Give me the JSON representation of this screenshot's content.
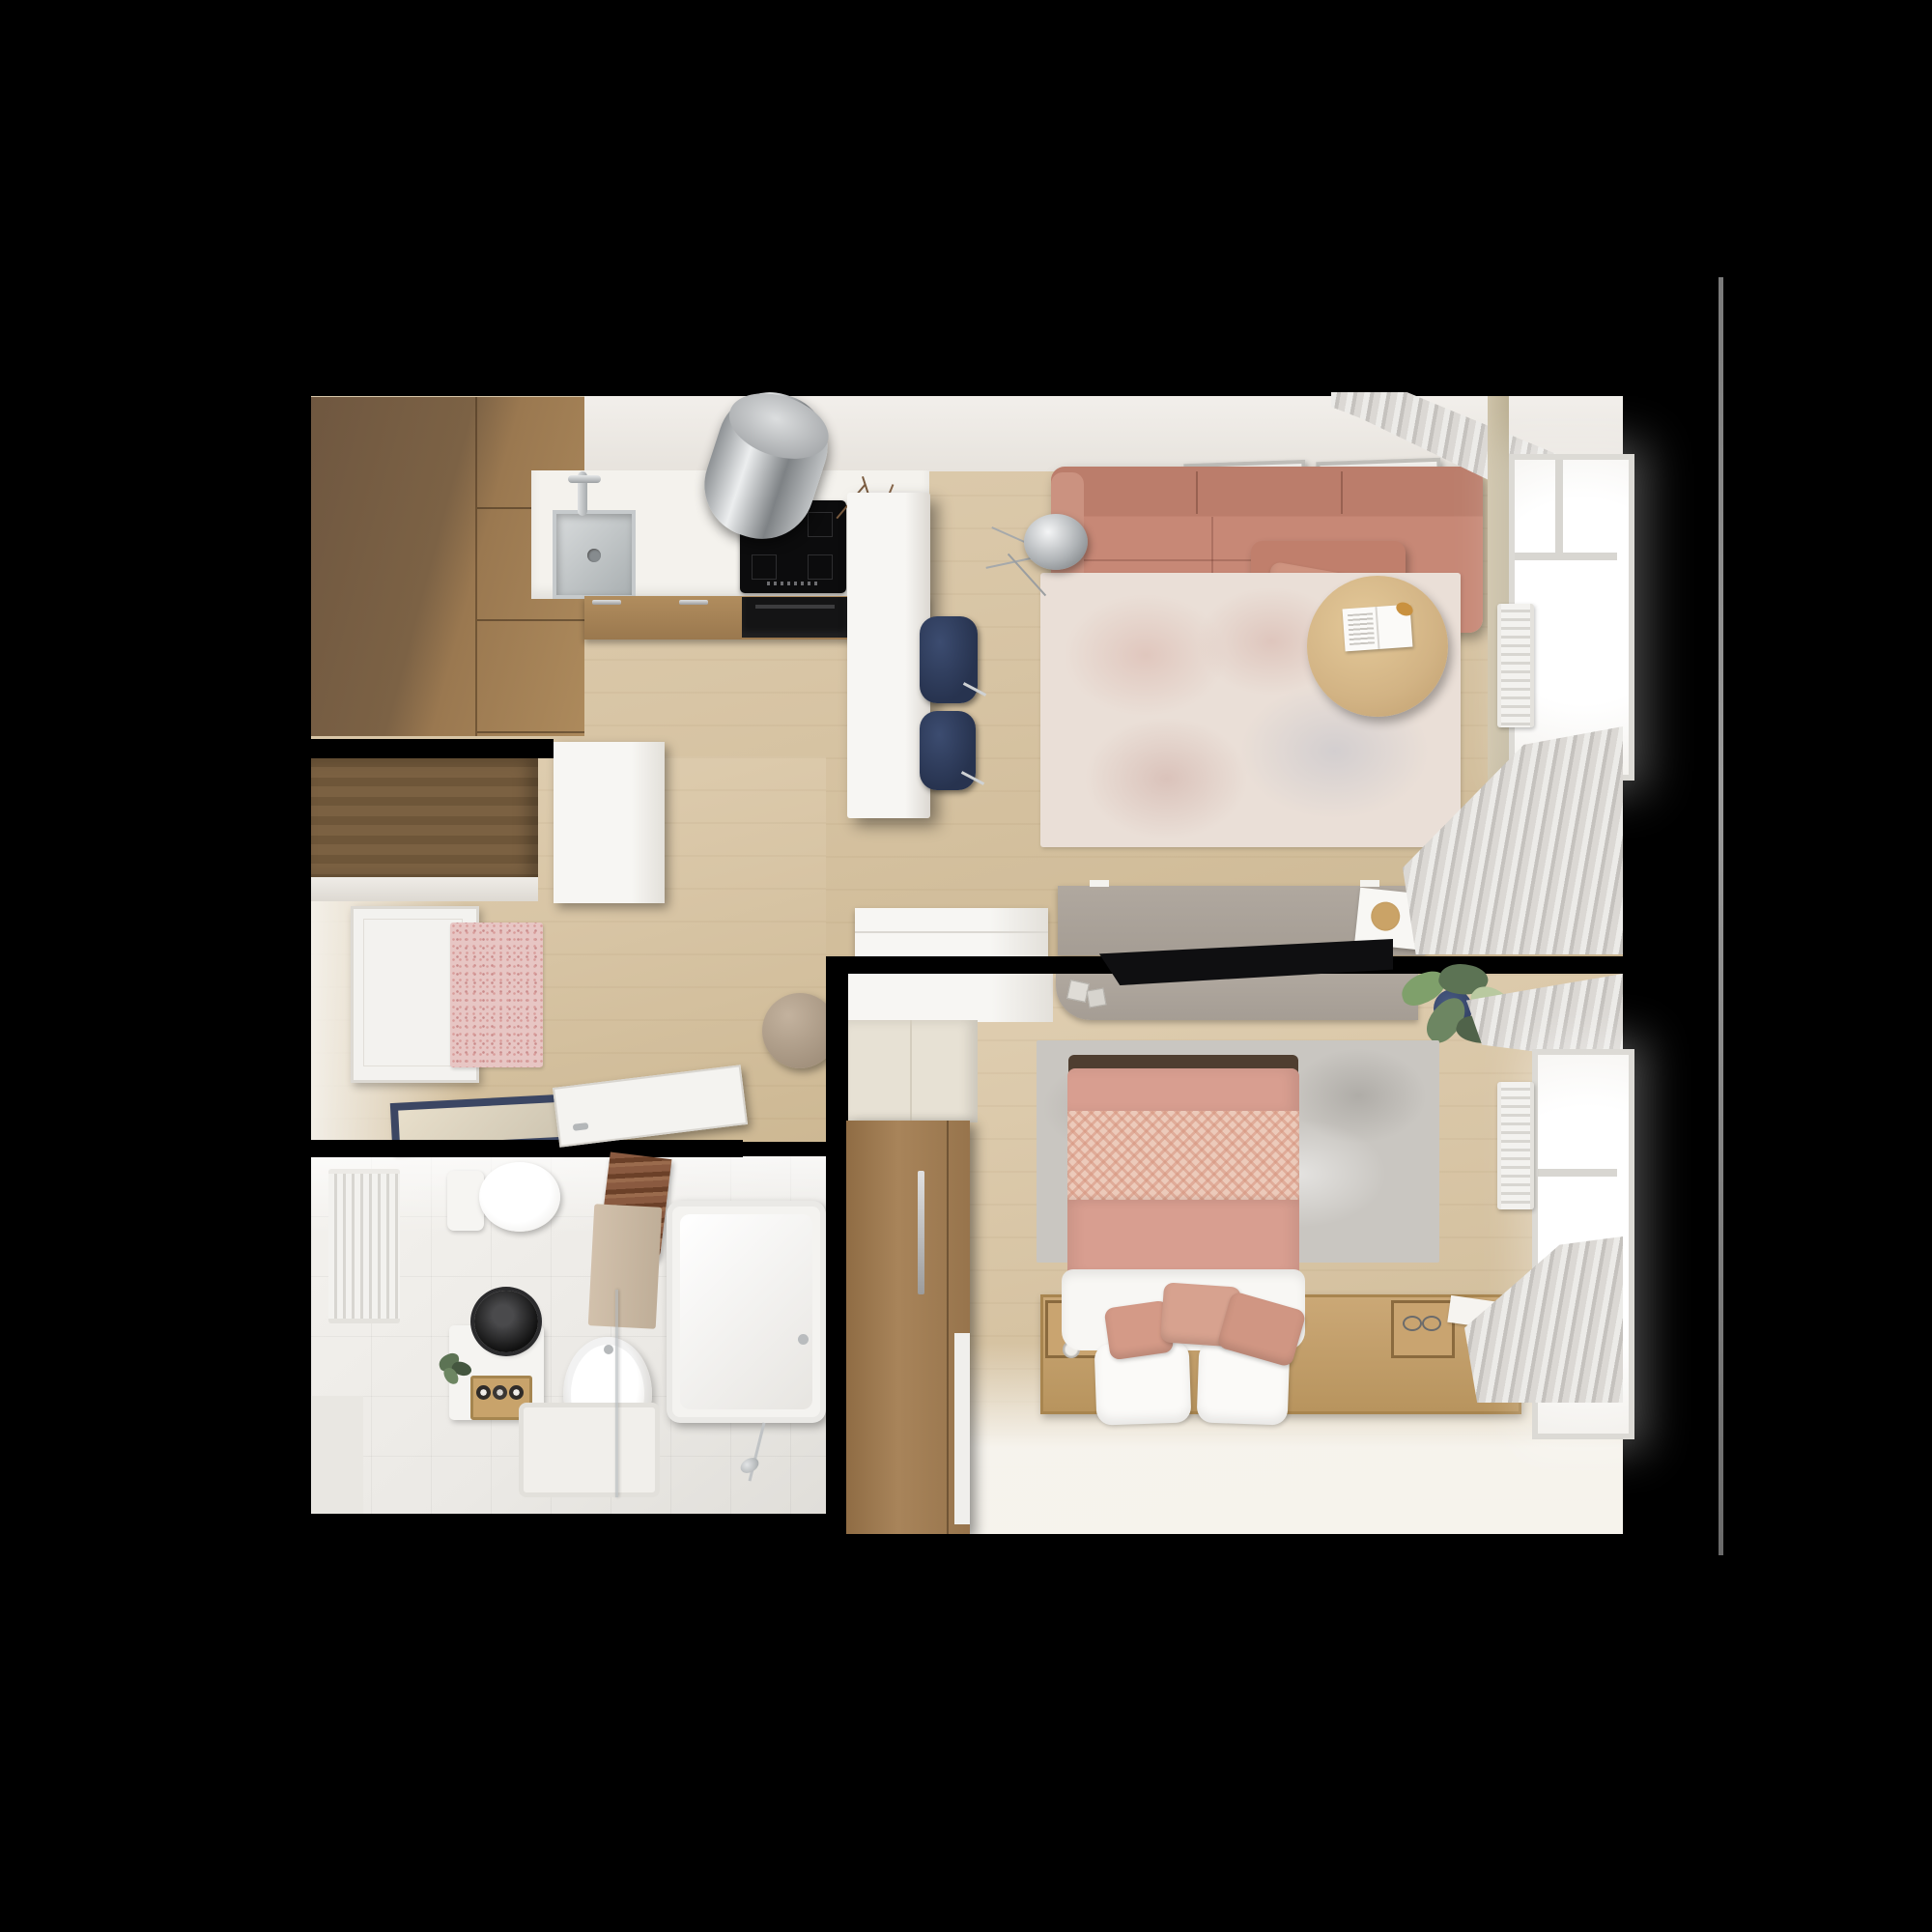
{
  "scene": {
    "type": "3d-rendered-top-down-floor-plan",
    "subject": "one-bedroom apartment interior visualization",
    "background": "#000000",
    "visible_text": "none"
  },
  "colors": {
    "floor": "#d8c5a5",
    "floor-light": "#e0cfb2",
    "floor-dark": "#cdb893",
    "tile": "#ebe9e5",
    "navy": "#27334f",
    "taupe": "#a59d94",
    "cushion": "#d49a87",
    "sofa": "#c78876",
    "sofa-dark": "#bb7d6b",
    "bed-pink": "#d89e90",
    "herringbone": "#eccaba",
    "rug-living": "#eadfd7",
    "rug-bedroom": "#c9c6c1",
    "cab-dark-wood": "#7c6245",
    "cab-light-wood": "#ad8a5c",
    "closet-wood": "#6e5639",
    "wardrobe-wood": "#a07c50",
    "platform-wood": "#c5a270",
    "table-wood": "#d2b384",
    "steel": "#b9bcbe",
    "appliance-black": "#0c0c0d",
    "curtain-gray": "#d3d0cc",
    "plant-green": "#5c7354",
    "plant-dark": "#44563f",
    "counter-white": "#f4f2ed",
    "pouf-beige": "#b3a28d",
    "mat-blue": "#3b4663",
    "hall-rug-pink": "#e7c6c4"
  },
  "rooms": [
    {
      "name": "kitchen",
      "furniture": [
        "tall wood cabinet block",
        "white countertop",
        "stainless sink with faucet",
        "black induction cooktop",
        "cylindrical stainless extractor hood",
        "built-in black oven",
        "lower wood cabinets with steel handles",
        "white island counter with twig vase",
        "two navy bar stools",
        "tall white cabinet"
      ]
    },
    {
      "name": "living-room",
      "furniture": [
        "two wall picture frames",
        "salmon fabric sofa with chaise and pillow",
        "chrome tripod floor lamp",
        "distressed cream-pink rug",
        "round wood coffee table with open magazine and croissant",
        "taupe desk with white book and wood coaster",
        "white sideboard",
        "green plant",
        "window with white frame",
        "gray curtains top and bottom",
        "white wall radiator"
      ]
    },
    {
      "name": "hallway",
      "furniture": [
        "dark wood closet with white shelf edge",
        "white entry door",
        "pink speckled runner rug",
        "round beige pouf",
        "navy-bordered doormat",
        "open white bathroom door leaf"
      ]
    },
    {
      "name": "bathroom",
      "furniture": [
        "white bar radiator",
        "toilet with tank",
        "brown slatted blind",
        "beige hanging towel",
        "white vanity with round black basin",
        "wood box with rolled towels",
        "small plant",
        "round freestanding tub",
        "square shower tray with glass screen",
        "rectangular bathtub",
        "chrome shower set"
      ]
    },
    {
      "name": "bedroom",
      "furniture": [
        "white top shelf cabinet",
        "cream closet",
        "taupe floating desk with black monitor",
        "two dice",
        "blue pot plant",
        "wood wardrobe with steel handle and white door sliver",
        "gray mottled rug",
        "double bed with pink duvet, herringbone blanket, white sheet, two white pillows, three salmon cushions",
        "dark headboard",
        "wood platform with side trays",
        "tray items: cup, glasses, card",
        "window with white frame",
        "gray curtains",
        "white wall radiator",
        "green plant near window"
      ]
    }
  ],
  "architecture": {
    "walls": [
      "kitchen-hallway wall",
      "hallway-bathroom wall with open door",
      "bedroom left wall",
      "bedroom-living wall with desk pass-over"
    ],
    "exterior_edge_line_right": true
  }
}
